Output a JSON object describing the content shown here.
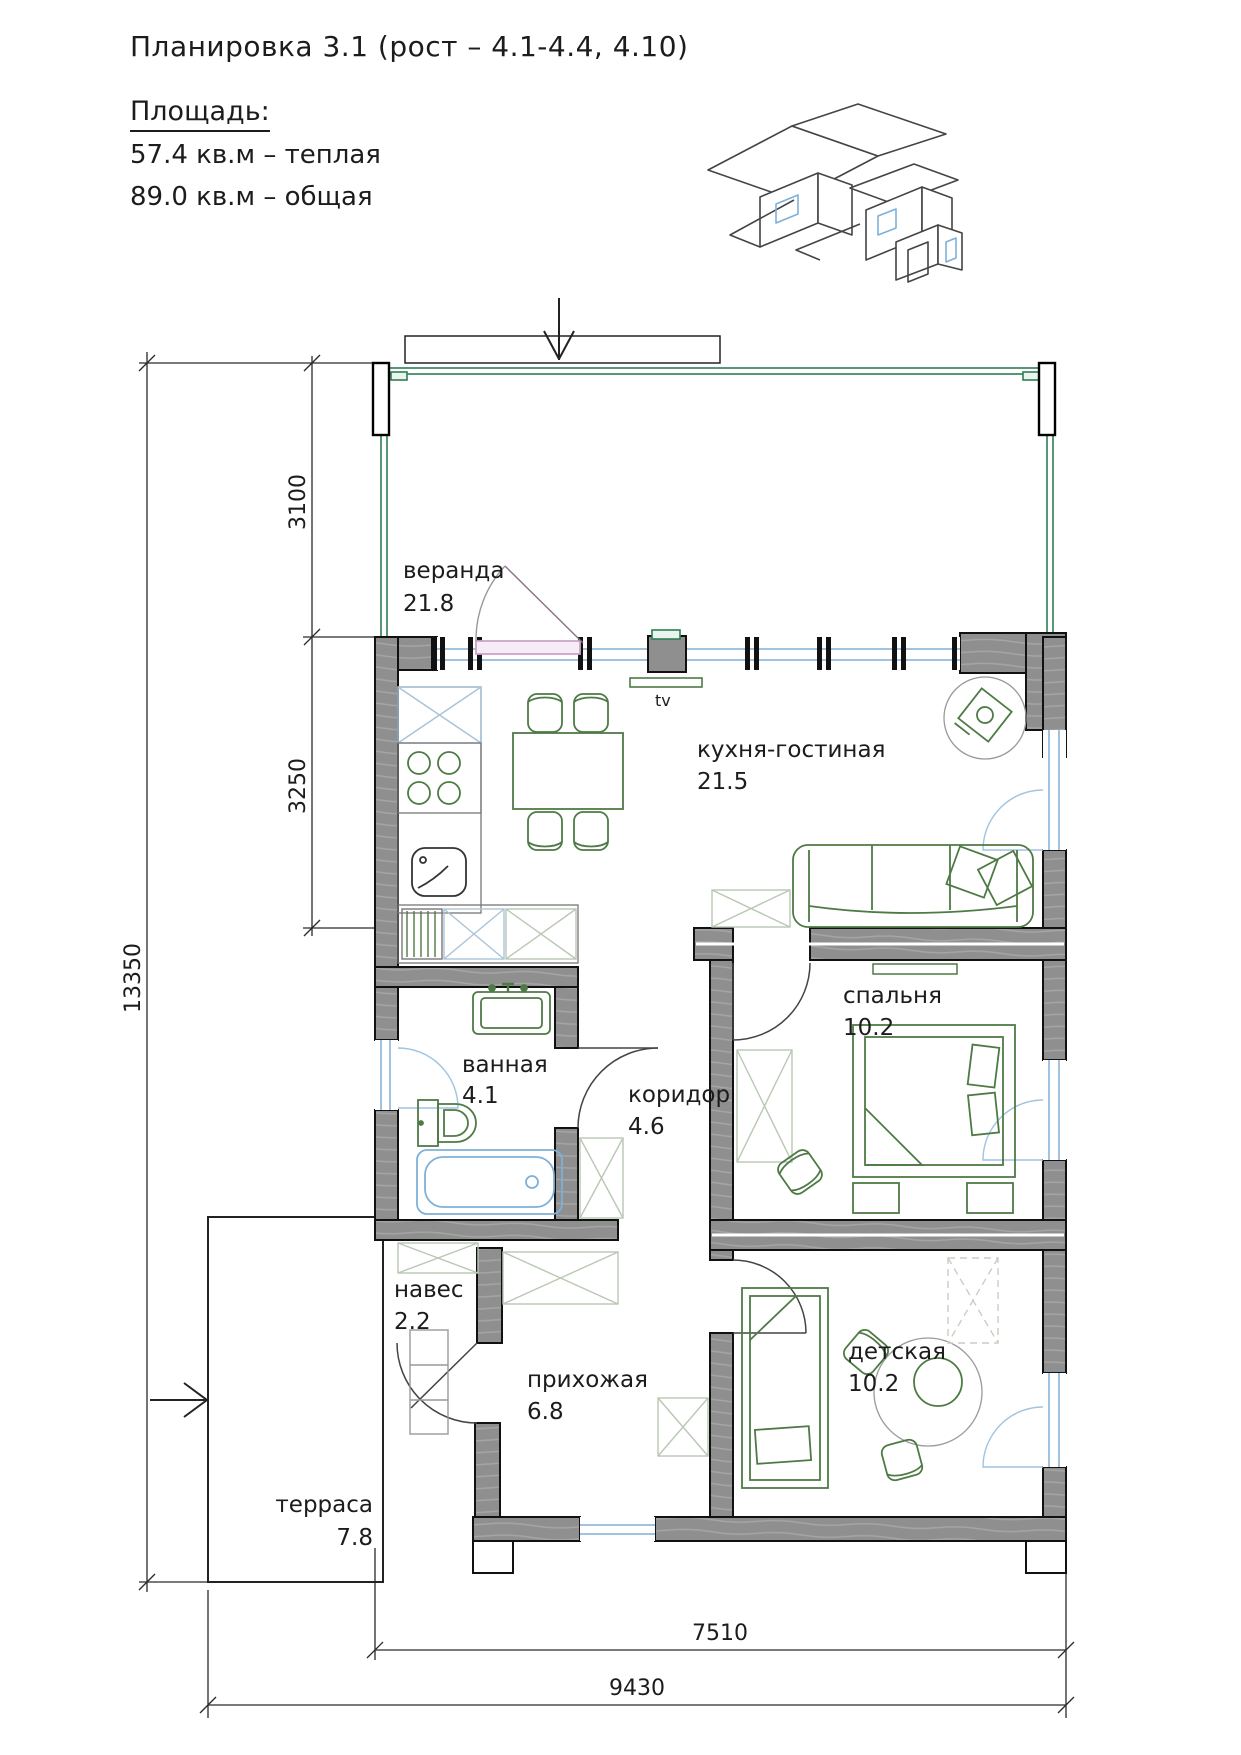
{
  "header": {
    "title": "Планировка 3.1 (рост – 4.1-4.4, 4.10)",
    "area_heading": "Площадь:",
    "area_warm": "57.4 кв.м – теплая",
    "area_total": "89.0 кв.м – общая"
  },
  "rooms": [
    {
      "name": "веранда",
      "area": "21.8"
    },
    {
      "name": "кухня-гостиная",
      "area": "21.5"
    },
    {
      "name": "спальня",
      "area": "10.2"
    },
    {
      "name": "ванная",
      "area": "4.1"
    },
    {
      "name": "коридор",
      "area": "4.6"
    },
    {
      "name": "навес",
      "area": "2.2"
    },
    {
      "name": "прихожая",
      "area": "6.8"
    },
    {
      "name": "детская",
      "area": "10.2"
    },
    {
      "name": "терраса",
      "area": "7.8"
    }
  ],
  "dimensions": {
    "overall_height": "13350",
    "veranda_depth": "3100",
    "kitchen_depth": "3250",
    "house_width": "7510",
    "total_width": "9430"
  },
  "annotations": {
    "tv": "tv"
  },
  "colors": {
    "wall_gray": "#8f8f8f",
    "veranda_green": "#2e7d54",
    "furniture_green": "#4e7a45",
    "window_blue": "#9fc3e0",
    "fixture_blue": "#7fb0d8",
    "door_pink": "#c9a5c9",
    "pale_cabinet": "#b9c7b4",
    "pale_appliance": "#aac3d8"
  }
}
